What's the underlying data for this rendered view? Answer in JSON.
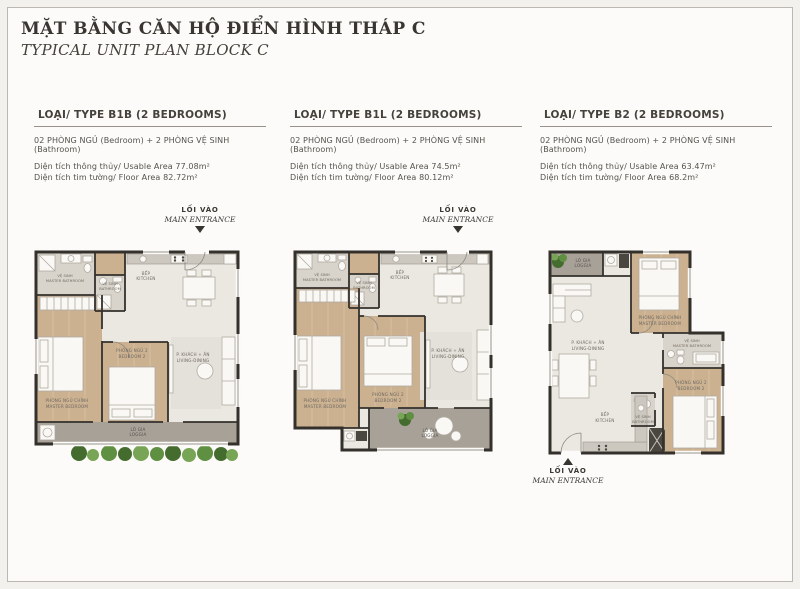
{
  "page": {
    "title": "MẶT BẰNG CĂN HỘ ĐIỂN HÌNH THÁP C",
    "subtitle": "TYPICAL UNIT PLAN BLOCK C"
  },
  "entrance": {
    "vi": "LỐI VÀO",
    "en": "MAIN ENTRANCE"
  },
  "rooms": {
    "master_bedroom": {
      "vi": "PHÒNG NGỦ CHÍNH",
      "en": "MASTER BEDROOM"
    },
    "bedroom2": {
      "vi": "PHÒNG NGỦ 2",
      "en": "BEDROOM 2"
    },
    "living": {
      "vi": "P. KHÁCH + ĂN",
      "en": "LIVING-DINING"
    },
    "kitchen": {
      "vi": "BẾP",
      "en": "KITCHEN"
    },
    "bathroom": {
      "vi": "VỆ SINH",
      "en": "BATHROOM"
    },
    "master_bathroom": {
      "vi": "VỆ SINH",
      "en": "MASTER BATHROOM"
    },
    "loggia": {
      "vi": "LÔ GIA",
      "en": "LOGGIA"
    }
  },
  "units": [
    {
      "heading": "LOẠI/ TYPE B1B (2 BEDROOMS)",
      "bedrooms": "02 PHÒNG NGỦ (Bedroom) + 2 PHÒNG VỆ SINH (Bathroom)",
      "usable": "Diện tích thông thủy/ Usable Area 77.08m²",
      "floor": "Diện tích tim tường/ Floor Area 82.72m²"
    },
    {
      "heading": "LOẠI/ TYPE B1L (2 BEDROOMS)",
      "bedrooms": "02 PHÒNG NGỦ (Bedroom) + 2 PHÒNG VỆ SINH (Bathroom)",
      "usable": "Diện tích thông thủy/ Usable Area 74.5m²",
      "floor": "Diện tích tim tường/ Floor Area 80.12m²"
    },
    {
      "heading": "LOẠI/ TYPE B2 (2 BEDROOMS)",
      "bedrooms": "02 PHÒNG NGỦ (Bedroom) + 2 PHÒNG VỆ SINH (Bathroom)",
      "usable": "Diện tích thông thủy/ Usable Area 63.47m²",
      "floor": "Diện tích tim tường/ Floor Area 68.2m²"
    }
  ],
  "colors": {
    "wall": "#34312d",
    "wood": "#ccb191",
    "floor": "#ebe8e2",
    "tile": "#d8d3cb",
    "loggia": "#a8a198",
    "plant_dark": "#446c2f",
    "accent_text": "#393631"
  }
}
